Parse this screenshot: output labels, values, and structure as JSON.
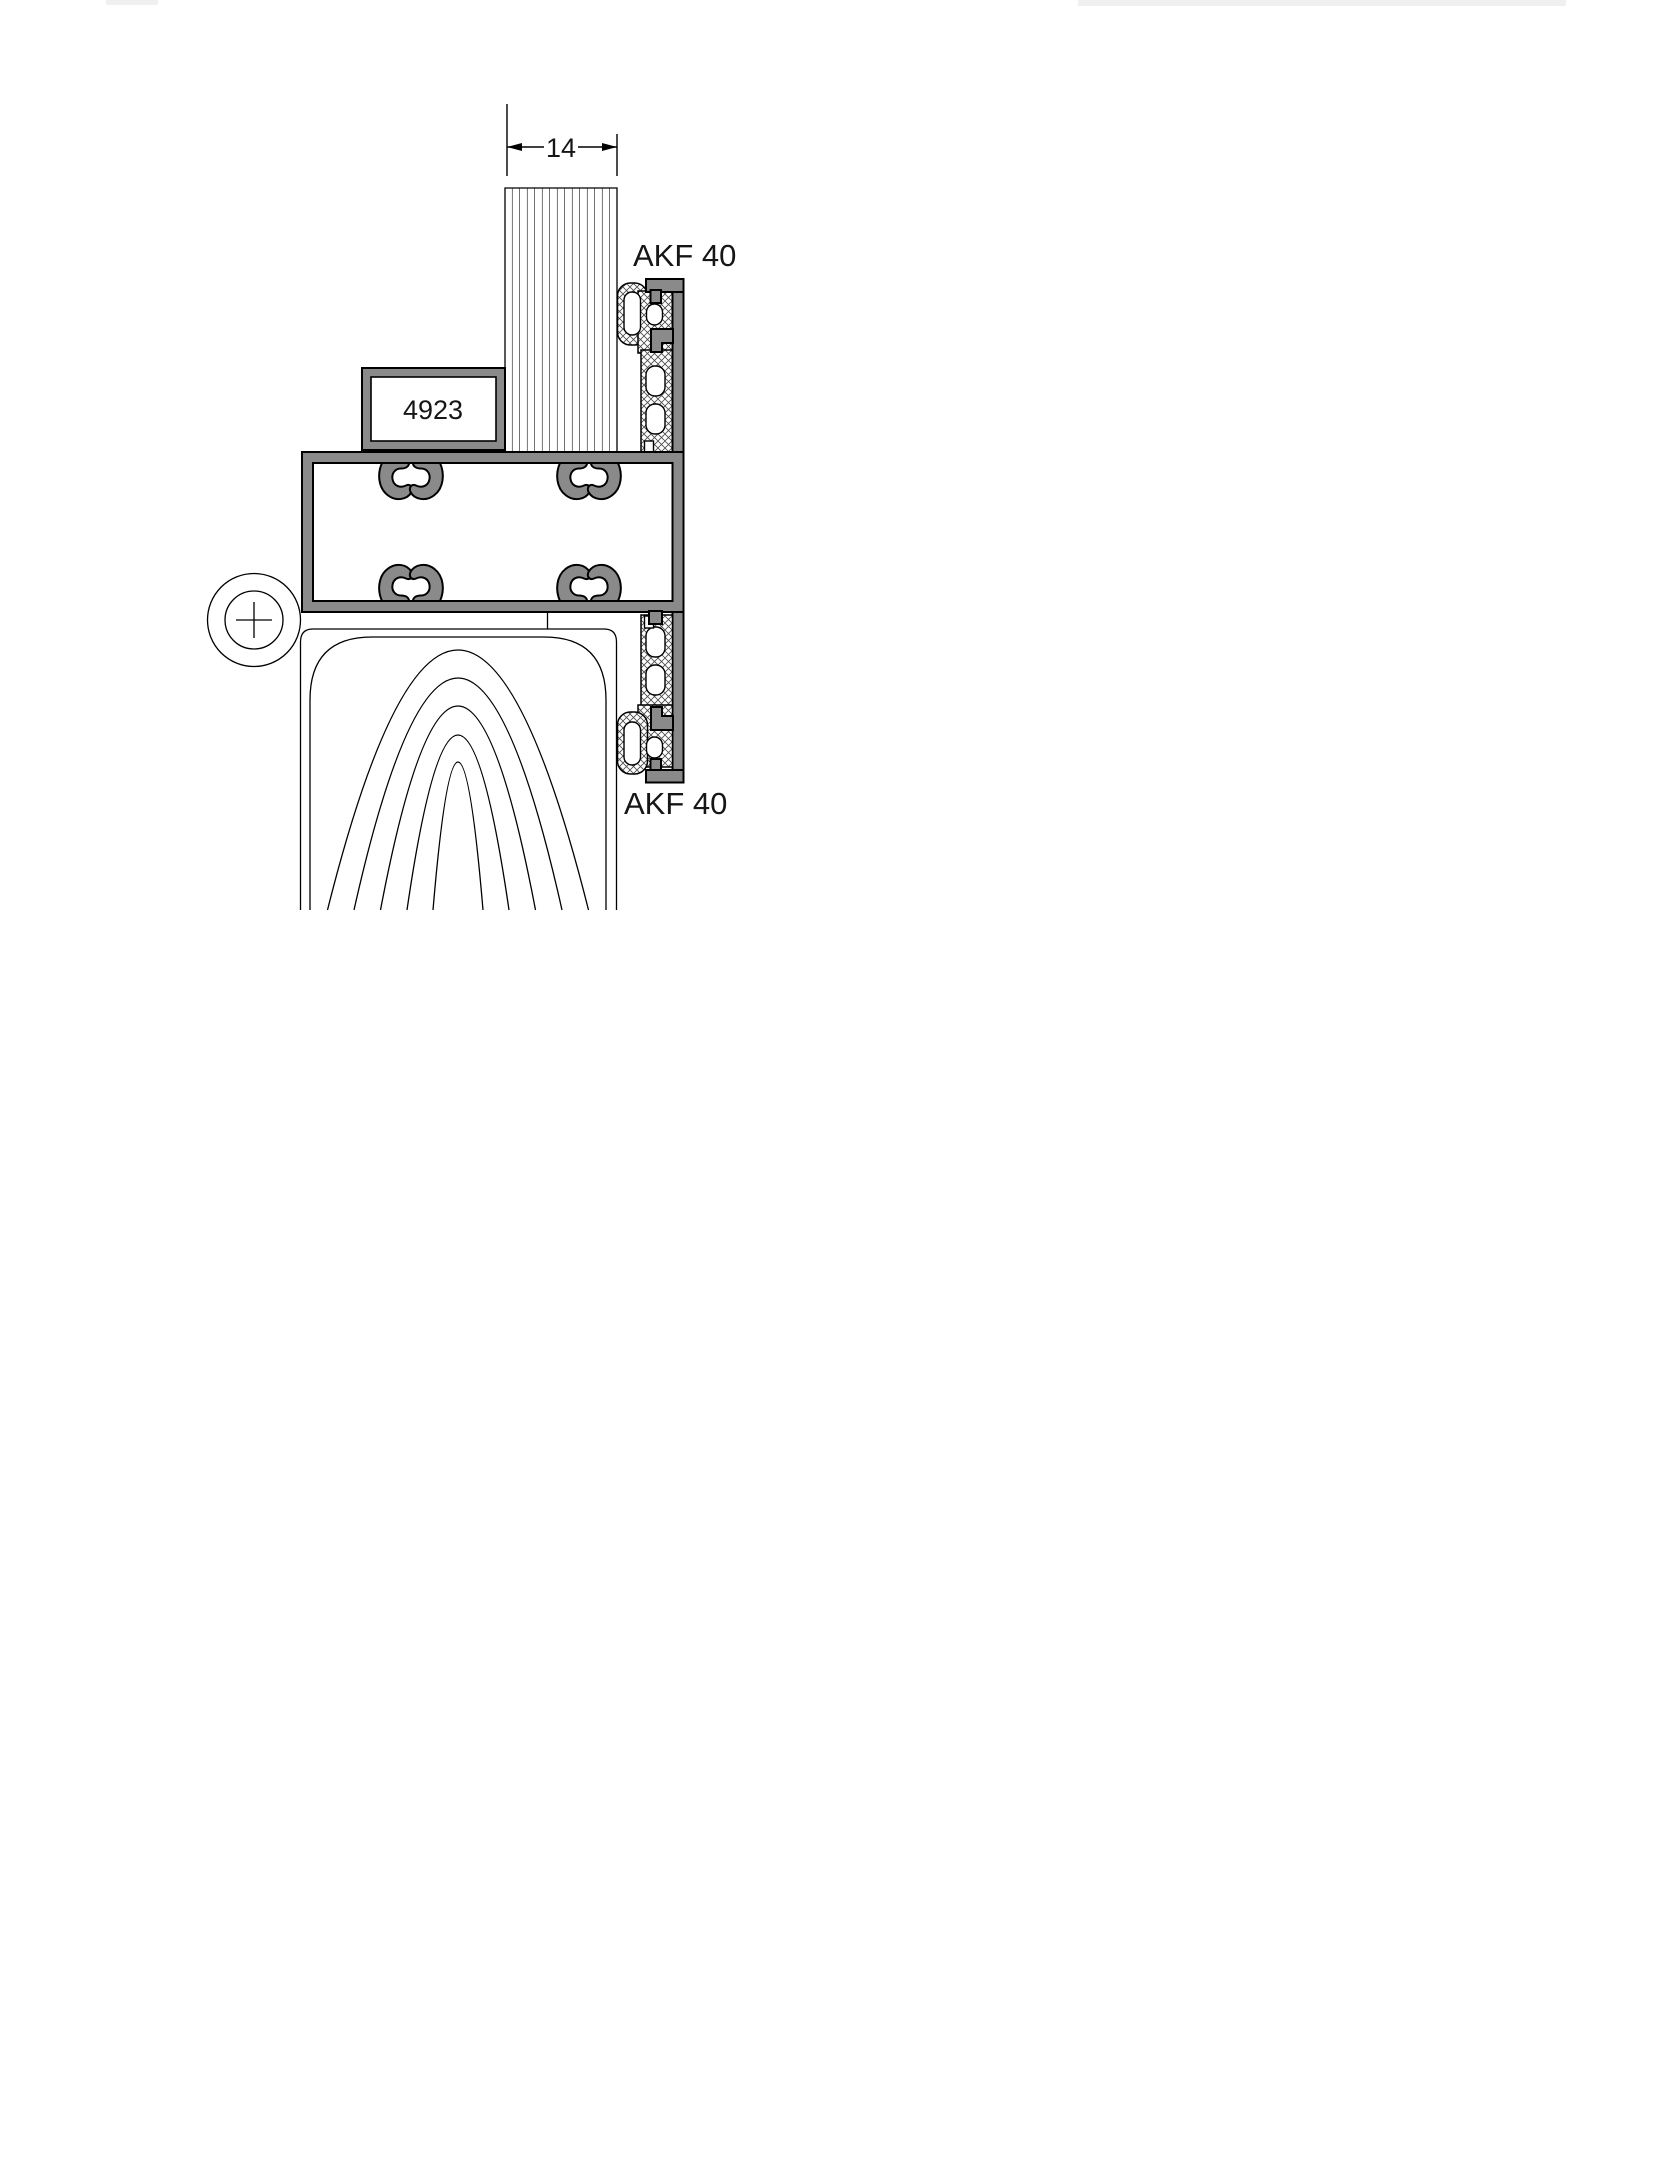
{
  "drawing": {
    "title": "profile-section-detail",
    "dimension": {
      "value": "14"
    },
    "labels": {
      "profile_top": "AKF 40",
      "profile_bottom": "AKF 40",
      "part_number": "4923"
    },
    "symbols": {
      "hinge_axis": "circle-crosshair",
      "wood_section": "grain-arcs",
      "panel_section": "vertical-hatch",
      "gasket_section": "cross-hatch"
    },
    "colors": {
      "aluminum": "#8a8a8a",
      "line": "#000000",
      "paper": "#ffffff"
    }
  }
}
